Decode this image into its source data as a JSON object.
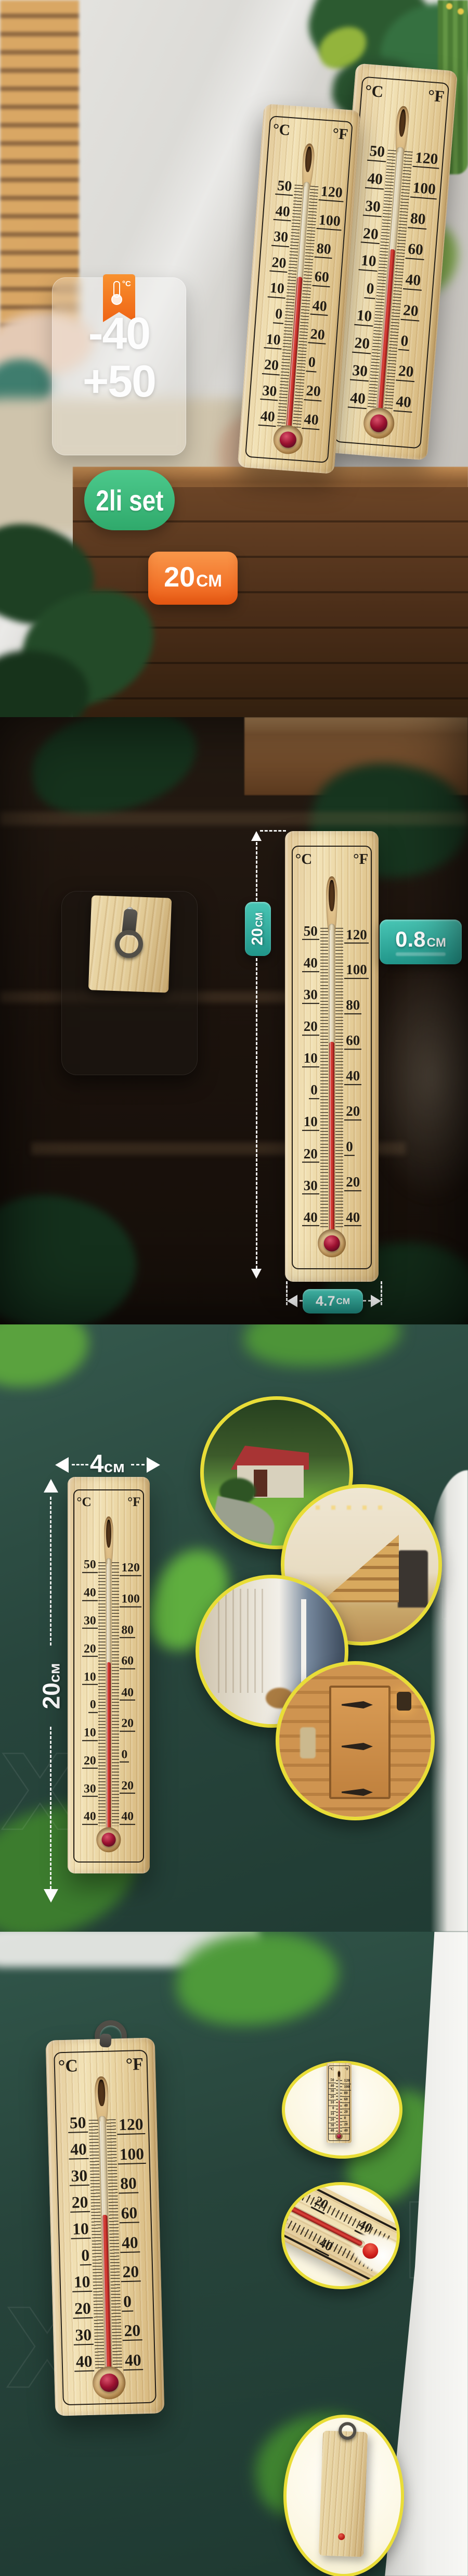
{
  "product": {
    "celsius_symbol": "°C",
    "fahrenheit_symbol": "°F",
    "celsius_scale": [
      "50",
      "40",
      "30",
      "20",
      "10",
      "0",
      "10",
      "20",
      "30",
      "40"
    ],
    "fahrenheit_scale": [
      "120",
      "100",
      "80",
      "60",
      "40",
      "20",
      "0",
      "20",
      "40"
    ]
  },
  "panel1": {
    "range_card": {
      "icon_label": "°C",
      "min": "-40",
      "max": "+50"
    },
    "set_badge": "2li set",
    "length_badge": {
      "value": "20",
      "unit": "CM"
    }
  },
  "panel2": {
    "height_badge": {
      "value": "20",
      "unit": "CM"
    },
    "thickness_badge": {
      "value": "0.8",
      "unit": "CM"
    },
    "width_badge": {
      "value": "4.7",
      "unit": "CM"
    }
  },
  "panel3": {
    "width_label": {
      "value": "4",
      "unit": "см"
    },
    "height_label": {
      "value": "20",
      "unit": "см"
    },
    "photos": [
      "garden-house",
      "staircase",
      "hallway-balcony",
      "sauna"
    ]
  },
  "panel4": {
    "closeup_celsius_labels": [
      "30",
      "40"
    ],
    "closeup_fahrenheit_labels": [
      "20",
      "40"
    ],
    "views": [
      "front-view",
      "bulb-closeup",
      "back-view"
    ]
  },
  "watermark": {
    "letter_x": "Х",
    "letter_h": "Н"
  },
  "colors": {
    "teal_badge": "#2ba99b",
    "green_badge": "#3fbf85",
    "orange_badge": "#f07122",
    "yellow_ring": "#e9dd37",
    "background_teal": "#29493f",
    "wood": "#ead9ab",
    "liquid_red": "#c62f2a"
  }
}
